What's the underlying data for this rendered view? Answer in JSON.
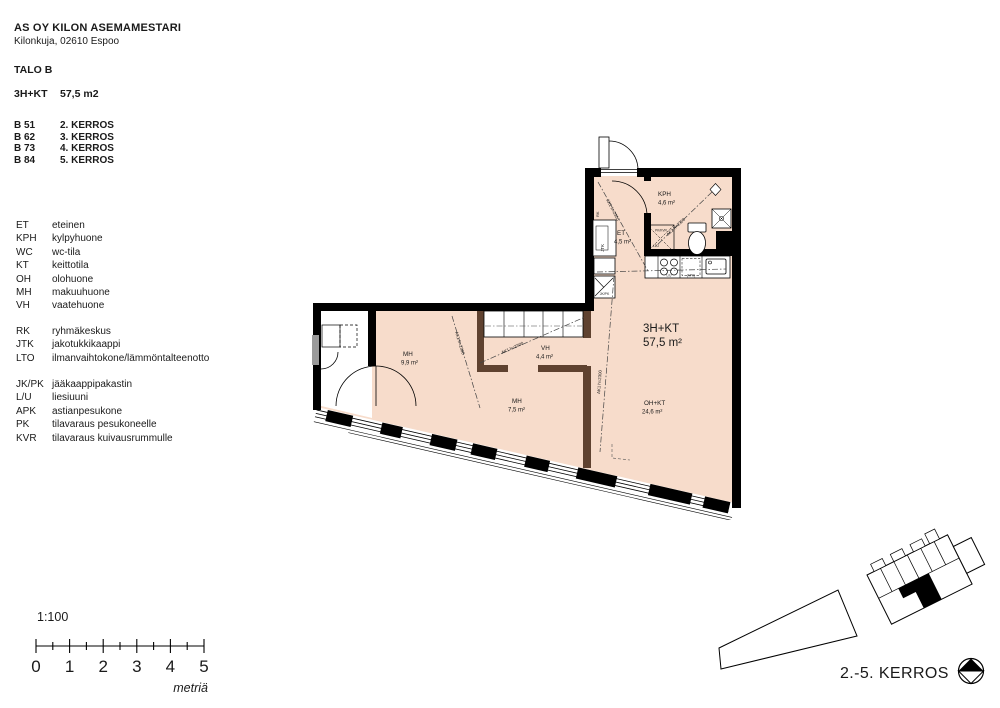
{
  "title_block": {
    "company": "AS OY KILON ASEMAMESTARI",
    "address": "Kilonkuja, 02610 Espoo",
    "building": "TALO B",
    "apartment_type": "3H+KT",
    "apartment_area": "57,5 m2",
    "units": [
      {
        "id": "B 51",
        "floor": "2. KERROS"
      },
      {
        "id": "B 62",
        "floor": "3. KERROS"
      },
      {
        "id": "B 73",
        "floor": "4. KERROS"
      },
      {
        "id": "B 84",
        "floor": "5. KERROS"
      }
    ]
  },
  "legend": {
    "groups": [
      {
        "items": [
          {
            "abbr": "ET",
            "label": "eteinen"
          },
          {
            "abbr": "KPH",
            "label": "kylpyhuone"
          },
          {
            "abbr": "WC",
            "label": "wc-tila"
          },
          {
            "abbr": "KT",
            "label": "keittotila"
          },
          {
            "abbr": "OH",
            "label": "olohuone"
          },
          {
            "abbr": "MH",
            "label": "makuuhuone"
          },
          {
            "abbr": "VH",
            "label": "vaatehuone"
          }
        ]
      },
      {
        "items": [
          {
            "abbr": "RK",
            "label": "ryhmäkeskus"
          },
          {
            "abbr": "JTK",
            "label": "jakotukkikaappi"
          },
          {
            "abbr": "LTO",
            "label": "ilmanvaihtokone/lämmöntalteenotto"
          }
        ]
      },
      {
        "items": [
          {
            "abbr": "JK/PK",
            "label": "jääkaappipakastin"
          },
          {
            "abbr": "L/U",
            "label": "liesiuuni"
          },
          {
            "abbr": "APK",
            "label": "astianpesukone"
          },
          {
            "abbr": "PK",
            "label": "tilavaraus pesukoneelle"
          },
          {
            "abbr": "KVR",
            "label": "tilavaraus kuivausrummulle"
          }
        ]
      }
    ]
  },
  "plan": {
    "rooms": [
      {
        "name": "KPH",
        "area": "4,6 m²"
      },
      {
        "name": "ET",
        "area": "4,5 m²"
      },
      {
        "name": "3H+KT",
        "area": "57,5 m²"
      },
      {
        "name": "OH+KT",
        "area": "24,6 m²"
      },
      {
        "name": "MH",
        "area": "9,9 m²"
      },
      {
        "name": "VH",
        "area": "4,4 m²"
      },
      {
        "name": "MH",
        "area": "7,5 m²"
      }
    ],
    "annotations": {
      "ak1": "AK1 h=2300",
      "ak2": "AK2 h=2300"
    },
    "fixtures": {
      "jtk": "JTK",
      "rk": "RK",
      "jk_pk": "JK/PK",
      "lu": "L/U",
      "apk": "(APK)",
      "pk_kvr": "PK/KVR",
      "lto": "LTO"
    },
    "colors": {
      "room_fill": "#f7dccb",
      "wall": "#000000",
      "interior_wall": "#5f4230"
    }
  },
  "scale": {
    "ratio": "1:100",
    "ticks": [
      "0",
      "1",
      "2",
      "3",
      "4",
      "5"
    ],
    "unit": "metriä"
  },
  "footer": {
    "floor_label": "2.-5. KERROS"
  }
}
